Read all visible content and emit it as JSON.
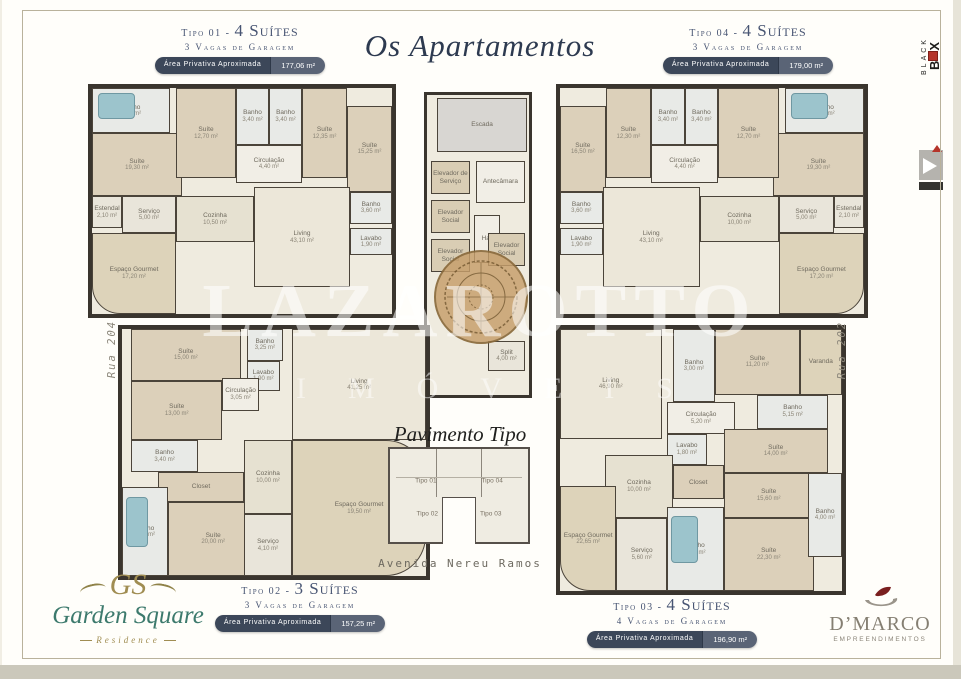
{
  "title": "Os Apartamentos",
  "watermark": {
    "line1": "LAZAROTTO",
    "line2": "IMÓVEIS"
  },
  "streets": {
    "left": "Rua 204",
    "right": "Rua 202",
    "bottom": "Avenida Nereu Ramos"
  },
  "center": {
    "title": "Pavimento Tipo",
    "mini_labels": [
      "Tipo 01",
      "Tipo 04",
      "Tipo 02",
      "Tipo 03"
    ]
  },
  "units": [
    {
      "id": "tipo01",
      "tipo": "Tipo 01 -",
      "suites": "4 Suítes",
      "vagas": "3 Vagas de Garagem",
      "area_label": "Área Privativa Aproximada",
      "area_value": "177,06 m²"
    },
    {
      "id": "tipo04",
      "tipo": "Tipo 04 -",
      "suites": "4 Suítes",
      "vagas": "3 Vagas de Garagem",
      "area_label": "Área Privativa Aproximada",
      "area_value": "179,00 m²"
    },
    {
      "id": "tipo02",
      "tipo": "Tipo 02 -",
      "suites": "3 Suítes",
      "vagas": "3 Vagas de Garagem",
      "area_label": "Área Privativa Aproximada",
      "area_value": "157,25 m²"
    },
    {
      "id": "tipo03",
      "tipo": "Tipo 03 -",
      "suites": "4 Suítes",
      "vagas": "4 Vagas de Garagem",
      "area_label": "Área Privativa Aproximada",
      "area_value": "196,90 m²"
    }
  ],
  "plans": {
    "tipo01": {
      "rooms": [
        {
          "label": "Banho",
          "area": "6,00 m²",
          "x": 0,
          "y": 0,
          "w": 26,
          "h": 20,
          "tint": "bath",
          "acc": "tub"
        },
        {
          "label": "Suíte",
          "area": "19,30 m²",
          "x": 0,
          "y": 20,
          "w": 30,
          "h": 28,
          "tint": "bed"
        },
        {
          "label": "Suíte",
          "area": "12,70 m²",
          "x": 28,
          "y": 0,
          "w": 20,
          "h": 40,
          "tint": "bed"
        },
        {
          "label": "Banho",
          "area": "3,40 m²",
          "x": 48,
          "y": 0,
          "w": 11,
          "h": 25,
          "tint": "bath"
        },
        {
          "label": "Banho",
          "area": "3,40 m²",
          "x": 59,
          "y": 0,
          "w": 11,
          "h": 25,
          "tint": "bath"
        },
        {
          "label": "Suíte",
          "area": "12,35 m²",
          "x": 70,
          "y": 0,
          "w": 15,
          "h": 40,
          "tint": "bed"
        },
        {
          "label": "Suíte",
          "area": "15,25 m²",
          "x": 85,
          "y": 8,
          "w": 15,
          "h": 38,
          "tint": "bed"
        },
        {
          "label": "Circulação",
          "area": "4,40 m²",
          "x": 48,
          "y": 25,
          "w": 22,
          "h": 17,
          "tint": "hall"
        },
        {
          "label": "Estendal",
          "area": "2,10 m²",
          "x": 0,
          "y": 48,
          "w": 10,
          "h": 14,
          "tint": "service"
        },
        {
          "label": "Serviço",
          "area": "5,00 m²",
          "x": 10,
          "y": 48,
          "w": 18,
          "h": 16,
          "tint": "service"
        },
        {
          "label": "Cozinha",
          "area": "10,50 m²",
          "x": 28,
          "y": 48,
          "w": 26,
          "h": 20,
          "tint": "kitchen"
        },
        {
          "label": "Living",
          "area": "43,10 m²",
          "x": 54,
          "y": 44,
          "w": 32,
          "h": 44,
          "tint": "living"
        },
        {
          "label": "Banho",
          "area": "3,60 m²",
          "x": 86,
          "y": 46,
          "w": 14,
          "h": 14,
          "tint": "bath"
        },
        {
          "label": "Lavabo",
          "area": "1,90 m²",
          "x": 86,
          "y": 62,
          "w": 14,
          "h": 12,
          "tint": "bath"
        },
        {
          "label": "Espaço Gourmet",
          "area": "17,20 m²",
          "x": 0,
          "y": 64,
          "w": 28,
          "h": 36,
          "tint": "balcony",
          "radius": "0 0 0 28px"
        }
      ]
    },
    "tipo04": {
      "rooms": [
        {
          "label": "Banho",
          "area": "6,00 m²",
          "x": 74,
          "y": 0,
          "w": 26,
          "h": 20,
          "tint": "bath",
          "acc": "tub"
        },
        {
          "label": "Suíte",
          "area": "19,30 m²",
          "x": 70,
          "y": 20,
          "w": 30,
          "h": 28,
          "tint": "bed"
        },
        {
          "label": "Suíte",
          "area": "12,70 m²",
          "x": 52,
          "y": 0,
          "w": 20,
          "h": 40,
          "tint": "bed"
        },
        {
          "label": "Banho",
          "area": "3,40 m²",
          "x": 41,
          "y": 0,
          "w": 11,
          "h": 25,
          "tint": "bath"
        },
        {
          "label": "Banho",
          "area": "3,40 m²",
          "x": 30,
          "y": 0,
          "w": 11,
          "h": 25,
          "tint": "bath"
        },
        {
          "label": "Suíte",
          "area": "12,30 m²",
          "x": 15,
          "y": 0,
          "w": 15,
          "h": 40,
          "tint": "bed"
        },
        {
          "label": "Suíte",
          "area": "16,50 m²",
          "x": 0,
          "y": 8,
          "w": 15,
          "h": 38,
          "tint": "bed"
        },
        {
          "label": "Circulação",
          "area": "4,40 m²",
          "x": 30,
          "y": 25,
          "w": 22,
          "h": 17,
          "tint": "hall"
        },
        {
          "label": "Estendal",
          "area": "2,10 m²",
          "x": 90,
          "y": 48,
          "w": 10,
          "h": 14,
          "tint": "service"
        },
        {
          "label": "Serviço",
          "area": "5,00 m²",
          "x": 72,
          "y": 48,
          "w": 18,
          "h": 16,
          "tint": "service"
        },
        {
          "label": "Cozinha",
          "area": "10,00 m²",
          "x": 46,
          "y": 48,
          "w": 26,
          "h": 20,
          "tint": "kitchen"
        },
        {
          "label": "Living",
          "area": "43,10 m²",
          "x": 14,
          "y": 44,
          "w": 32,
          "h": 44,
          "tint": "living"
        },
        {
          "label": "Banho",
          "area": "3,60 m²",
          "x": 0,
          "y": 46,
          "w": 14,
          "h": 14,
          "tint": "bath"
        },
        {
          "label": "Lavabo",
          "area": "1,90 m²",
          "x": 0,
          "y": 62,
          "w": 14,
          "h": 12,
          "tint": "bath"
        },
        {
          "label": "Espaço Gourmet",
          "area": "17,20 m²",
          "x": 72,
          "y": 64,
          "w": 28,
          "h": 36,
          "tint": "balcony",
          "radius": "0 0 28px 0"
        }
      ]
    },
    "core": {
      "rooms": [
        {
          "label": "Escada",
          "area": "",
          "x": 10,
          "y": 1,
          "w": 88,
          "h": 18,
          "tint": "stair"
        },
        {
          "label": "Elevador de Serviço",
          "area": "",
          "x": 4,
          "y": 22,
          "w": 38,
          "h": 11,
          "tint": "elev"
        },
        {
          "label": "Antecâmara",
          "area": "",
          "x": 48,
          "y": 22,
          "w": 48,
          "h": 14,
          "tint": "hall"
        },
        {
          "label": "Elevador Social",
          "area": "",
          "x": 4,
          "y": 35,
          "w": 38,
          "h": 11,
          "tint": "elev"
        },
        {
          "label": "Elevador Social",
          "area": "",
          "x": 4,
          "y": 48,
          "w": 38,
          "h": 11,
          "tint": "elev"
        },
        {
          "label": "Hall",
          "area": "",
          "x": 46,
          "y": 40,
          "w": 26,
          "h": 16,
          "tint": "hall"
        },
        {
          "label": "Elevador Social",
          "area": "",
          "x": 60,
          "y": 46,
          "w": 36,
          "h": 11,
          "tint": "elev"
        },
        {
          "label": "Split",
          "area": "4,00 m²",
          "x": 60,
          "y": 82,
          "w": 36,
          "h": 10,
          "tint": "service"
        }
      ]
    },
    "tipo02": {
      "rooms": [
        {
          "label": "Suíte",
          "area": "15,00 m²",
          "x": 3,
          "y": 0,
          "w": 36,
          "h": 21,
          "tint": "bed"
        },
        {
          "label": "Banho",
          "area": "3,25 m²",
          "x": 41,
          "y": 0,
          "w": 12,
          "h": 13,
          "tint": "bath"
        },
        {
          "label": "Lavabo",
          "area": "1,90 m²",
          "x": 41,
          "y": 13,
          "w": 11,
          "h": 12,
          "tint": "bath"
        },
        {
          "label": "Living",
          "area": "41,25 m²",
          "x": 56,
          "y": 0,
          "w": 44,
          "h": 45,
          "tint": "living"
        },
        {
          "label": "Circulação",
          "area": "3,05 m²",
          "x": 33,
          "y": 20,
          "w": 12,
          "h": 13,
          "tint": "hall"
        },
        {
          "label": "Suíte",
          "area": "13,00 m²",
          "x": 3,
          "y": 21,
          "w": 30,
          "h": 24,
          "tint": "bed"
        },
        {
          "label": "Banho",
          "area": "3,40 m²",
          "x": 3,
          "y": 45,
          "w": 22,
          "h": 13,
          "tint": "bath"
        },
        {
          "label": "Closet",
          "area": "",
          "x": 12,
          "y": 58,
          "w": 28,
          "h": 12,
          "tint": "bed"
        },
        {
          "label": "Banho",
          "area": "5,15 m²",
          "x": 0,
          "y": 64,
          "w": 15,
          "h": 36,
          "tint": "bath",
          "acc": "tub"
        },
        {
          "label": "Suíte",
          "area": "20,00 m²",
          "x": 15,
          "y": 70,
          "w": 30,
          "h": 30,
          "tint": "bed"
        },
        {
          "label": "Cozinha",
          "area": "10,00 m²",
          "x": 40,
          "y": 45,
          "w": 16,
          "h": 30,
          "tint": "kitchen"
        },
        {
          "label": "Serviço",
          "area": "4,10 m²",
          "x": 40,
          "y": 75,
          "w": 16,
          "h": 25,
          "tint": "service"
        },
        {
          "label": "Espaço Gourmet",
          "area": "19,50 m²",
          "x": 56,
          "y": 45,
          "w": 44,
          "h": 55,
          "tint": "balcony",
          "radius": "0 40px 40px 0"
        }
      ]
    },
    "tipo03": {
      "rooms": [
        {
          "label": "Living",
          "area": "46,90 m²",
          "x": 0,
          "y": 0,
          "w": 36,
          "h": 42,
          "tint": "living"
        },
        {
          "label": "Banho",
          "area": "3,00 m²",
          "x": 40,
          "y": 0,
          "w": 15,
          "h": 28,
          "tint": "bath"
        },
        {
          "label": "Suíte",
          "area": "11,20 m²",
          "x": 55,
          "y": 0,
          "w": 30,
          "h": 25,
          "tint": "bed"
        },
        {
          "label": "Varanda",
          "area": "",
          "x": 85,
          "y": 0,
          "w": 15,
          "h": 25,
          "tint": "balcony"
        },
        {
          "label": "Banho",
          "area": "5,15 m²",
          "x": 70,
          "y": 25,
          "w": 25,
          "h": 13,
          "tint": "bath"
        },
        {
          "label": "Circulação",
          "area": "5,20 m²",
          "x": 38,
          "y": 28,
          "w": 24,
          "h": 12,
          "tint": "hall"
        },
        {
          "label": "Lavabo",
          "area": "1,80 m²",
          "x": 38,
          "y": 40,
          "w": 14,
          "h": 12,
          "tint": "bath"
        },
        {
          "label": "Suíte",
          "area": "14,00 m²",
          "x": 58,
          "y": 38,
          "w": 37,
          "h": 17,
          "tint": "bed"
        },
        {
          "label": "Closet",
          "area": "",
          "x": 40,
          "y": 52,
          "w": 18,
          "h": 13,
          "tint": "bed"
        },
        {
          "label": "Suíte",
          "area": "15,60 m²",
          "x": 58,
          "y": 55,
          "w": 32,
          "h": 17,
          "tint": "bed"
        },
        {
          "label": "Cozinha",
          "area": "10,00 m²",
          "x": 16,
          "y": 48,
          "w": 24,
          "h": 24,
          "tint": "kitchen"
        },
        {
          "label": "Espaço Gourmet",
          "area": "22,65 m²",
          "x": 0,
          "y": 60,
          "w": 20,
          "h": 40,
          "tint": "balcony",
          "radius": "0 0 0 30px"
        },
        {
          "label": "Serviço",
          "area": "5,60 m²",
          "x": 20,
          "y": 72,
          "w": 18,
          "h": 28,
          "tint": "service"
        },
        {
          "label": "Banho",
          "area": "6,50 m²",
          "x": 38,
          "y": 68,
          "w": 20,
          "h": 32,
          "tint": "bath",
          "acc": "tub"
        },
        {
          "label": "Suíte",
          "area": "22,30 m²",
          "x": 58,
          "y": 72,
          "w": 32,
          "h": 28,
          "tint": "bed"
        },
        {
          "label": "Banho",
          "area": "4,00 m²",
          "x": 88,
          "y": 55,
          "w": 12,
          "h": 32,
          "tint": "bath"
        }
      ]
    }
  },
  "logos": {
    "garden": {
      "monogram": "GS",
      "name": "Garden Square",
      "sub": "Residence"
    },
    "dmarco": {
      "name": "D’MARCO",
      "sub": "EMPREENDIMENTOS"
    },
    "blackbox": {
      "line1": "BLACK",
      "line2_left": "B",
      "line2_right": "X"
    }
  },
  "colors": {
    "heading_navy": "#475472",
    "badge_dark": "#3c4759",
    "badge_light": "#5a6476",
    "garden_teal": "#3d7a6d",
    "garden_gold": "#a08d52",
    "dmarco_gray": "#857f72",
    "blackbox_red": "#b5342a"
  }
}
